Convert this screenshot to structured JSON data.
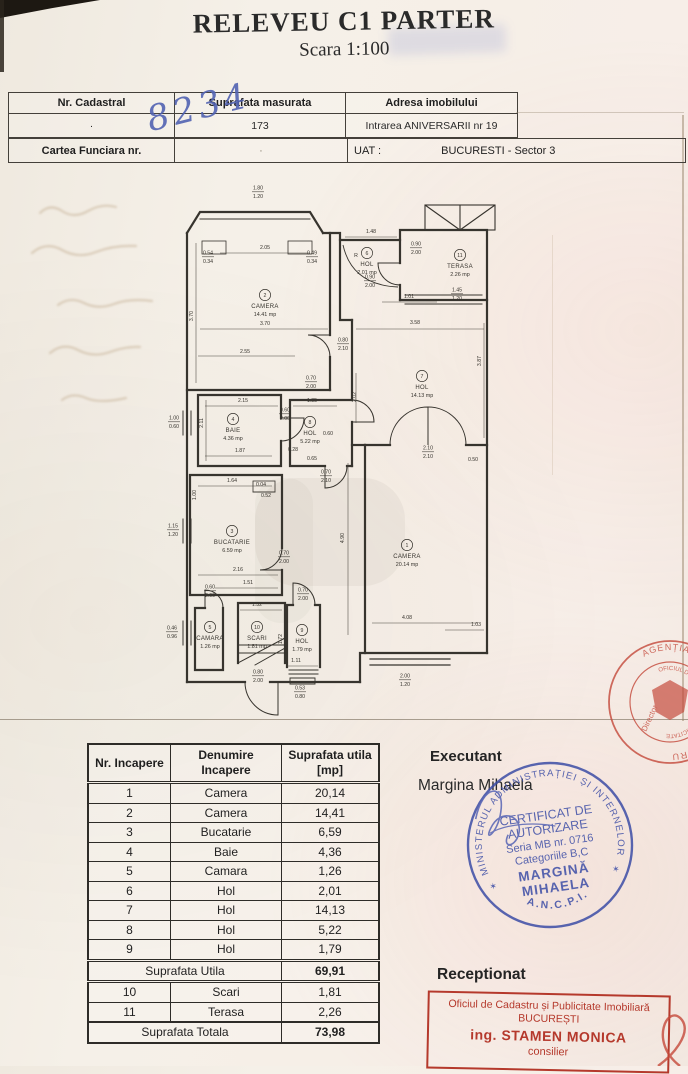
{
  "title": "RELEVEU C1 PARTER",
  "subtitle": "Scara 1:100",
  "header": {
    "nr_cadastral_label": "Nr. Cadastral",
    "nr_cadastral_value": "8234",
    "suprafata_label": "Suprafata masurata",
    "suprafata_value": "173",
    "adresa_label": "Adresa imobilului",
    "adresa_value": "Intrarea ANIVERSARII nr 19",
    "carte_funciara_label": "Cartea Funciara nr.",
    "uat_label": "UAT :",
    "uat_value": "BUCURESTI - Sector 3"
  },
  "plan": {
    "rooms": [
      {
        "num": "1",
        "name": "CAMERA",
        "area": "20.14 mp",
        "x": 247,
        "y": 366
      },
      {
        "num": "2",
        "name": "CAMERA",
        "area": "14.41 mp",
        "x": 105,
        "y": 116
      },
      {
        "num": "3",
        "name": "BUCATARIE",
        "area": "6.59 mp",
        "x": 72,
        "y": 352
      },
      {
        "num": "4",
        "name": "BAIE",
        "area": "4.36 mp",
        "x": 73,
        "y": 240
      },
      {
        "num": "5",
        "name": "CAMARA",
        "area": "1.26 mp",
        "x": 50,
        "y": 448
      },
      {
        "num": "6",
        "name": "HOL",
        "area": "2.01 mp",
        "x": 207,
        "y": 74
      },
      {
        "num": "7",
        "name": "HOL",
        "area": "14.13 mp",
        "x": 262,
        "y": 197
      },
      {
        "num": "8",
        "name": "HOL",
        "area": "5.22 mp",
        "x": 150,
        "y": 243
      },
      {
        "num": "9",
        "name": "HOL",
        "area": "1.79 mp",
        "x": 142,
        "y": 451
      },
      {
        "num": "10",
        "name": "SCARI",
        "area": "1.81 mp",
        "x": 97,
        "y": 448
      },
      {
        "num": "11",
        "name": "TERASA",
        "area": "2.26 mp",
        "x": 300,
        "y": 76
      }
    ],
    "dims": [
      {
        "a": "1.80",
        "b": "1.20",
        "x": 98,
        "y": 8
      },
      {
        "t": "2.05",
        "x": 105,
        "y": 66
      },
      {
        "a": "0.54",
        "b": "0.34",
        "x": 48,
        "y": 73
      },
      {
        "a": "0.49",
        "b": "0.34",
        "x": 152,
        "y": 73
      },
      {
        "t": "3.70",
        "x": 33,
        "y": 133,
        "rot": true
      },
      {
        "t": "3.70",
        "x": 105,
        "y": 142
      },
      {
        "t": "2.55",
        "x": 85,
        "y": 170
      },
      {
        "a": "0.80",
        "b": "2.10",
        "x": 183,
        "y": 160
      },
      {
        "a": "0.70",
        "b": "2.00",
        "x": 151,
        "y": 198
      },
      {
        "t": "1.48",
        "x": 211,
        "y": 50
      },
      {
        "t": "R",
        "x": 196,
        "y": 74
      },
      {
        "a": "0.90",
        "b": "2.00",
        "x": 256,
        "y": 64
      },
      {
        "a": "0.90",
        "b": "2.00",
        "x": 210,
        "y": 97
      },
      {
        "t": "1.01",
        "x": 249,
        "y": 115
      },
      {
        "a": "1.45",
        "b": "1.20",
        "x": 297,
        "y": 110
      },
      {
        "t": "3.58",
        "x": 255,
        "y": 141
      },
      {
        "t": "2.02",
        "x": 196,
        "y": 214,
        "rot": true
      },
      {
        "t": "3.87",
        "x": 321,
        "y": 178,
        "rot": true
      },
      {
        "a": "2.10",
        "b": "2.10",
        "x": 268,
        "y": 268
      },
      {
        "t": "0.50",
        "x": 313,
        "y": 278
      },
      {
        "t": "4.90",
        "x": 184,
        "y": 355,
        "rot": true
      },
      {
        "t": "4.08",
        "x": 247,
        "y": 436
      },
      {
        "t": "1.03",
        "x": 316,
        "y": 443
      },
      {
        "a": "2.00",
        "b": "1.20",
        "x": 245,
        "y": 496
      },
      {
        "t": "2.15",
        "x": 83,
        "y": 219
      },
      {
        "t": "2.11",
        "x": 43,
        "y": 240,
        "rot": true
      },
      {
        "t": "1.87",
        "x": 80,
        "y": 269
      },
      {
        "a": "0.60",
        "b": "2.00",
        "x": 125,
        "y": 230
      },
      {
        "t": "1.35",
        "x": 152,
        "y": 219
      },
      {
        "t": "0.28",
        "x": 133,
        "y": 268
      },
      {
        "t": "0.65",
        "x": 152,
        "y": 277
      },
      {
        "t": "0.60",
        "x": 168,
        "y": 252
      },
      {
        "a": "0.70",
        "b": "2.10",
        "x": 166,
        "y": 292
      },
      {
        "t": "1.64",
        "x": 72,
        "y": 299
      },
      {
        "t": "1.00",
        "x": 36,
        "y": 312,
        "rot": true
      },
      {
        "t": "0.04",
        "x": 101,
        "y": 303
      },
      {
        "t": "0.52",
        "x": 106,
        "y": 314
      },
      {
        "a": "0.70",
        "b": "2.00",
        "x": 124,
        "y": 373
      },
      {
        "t": "2.16",
        "x": 78,
        "y": 388
      },
      {
        "t": "1.51",
        "x": 88,
        "y": 401
      },
      {
        "a": "0.60",
        "b": "2.00",
        "x": 50,
        "y": 407
      },
      {
        "a": "1.00",
        "b": "0.60",
        "x": 14,
        "y": 238
      },
      {
        "a": "1.15",
        "b": "1.20",
        "x": 13,
        "y": 346
      },
      {
        "a": "0.46",
        "b": "0.96",
        "x": 12,
        "y": 448
      },
      {
        "t": "1.32",
        "x": 97,
        "y": 423
      },
      {
        "t": "1.72",
        "x": 122,
        "y": 456,
        "rot": true
      },
      {
        "a": "0.70",
        "b": "2.00",
        "x": 143,
        "y": 410
      },
      {
        "t": "1.11",
        "x": 136,
        "y": 479
      },
      {
        "a": "0.80",
        "b": "2.00",
        "x": 98,
        "y": 492
      },
      {
        "a": "0.53",
        "b": "0.80",
        "x": 140,
        "y": 508
      }
    ]
  },
  "area_table": {
    "headers": [
      "Nr. Incapere",
      "Denumire\nIncapere",
      "Suprafata utila\n[mp]"
    ],
    "rows": [
      [
        "1",
        "Camera",
        "20,14"
      ],
      [
        "2",
        "Camera",
        "14,41"
      ],
      [
        "3",
        "Bucatarie",
        "6,59"
      ],
      [
        "4",
        "Baie",
        "4,36"
      ],
      [
        "5",
        "Camara",
        "1,26"
      ],
      [
        "6",
        "Hol",
        "2,01"
      ],
      [
        "7",
        "Hol",
        "14,13"
      ],
      [
        "8",
        "Hol",
        "5,22"
      ],
      [
        "9",
        "Hol",
        "1,79"
      ]
    ],
    "subtotal_label": "Suprafata Utila",
    "subtotal_value": "69,91",
    "rows2": [
      [
        "10",
        "Scari",
        "1,81"
      ],
      [
        "11",
        "Terasa",
        "2,26"
      ]
    ],
    "total_label": "Suprafata Totala",
    "total_value": "73,98"
  },
  "executant_label": "Executant",
  "executant_name": "Margina Mihaela",
  "receptionat_label": "Receptionat",
  "stamps": {
    "blue": {
      "ring": "MINISTERUL ADMINISTRAȚIEI ȘI INTERNELOR",
      "bottom": "A.N.C.P.I.",
      "lines": [
        "CERTIFICAT DE",
        "AUTORIZARE",
        "Seria MB nr. 0716",
        "Categoriile B,C",
        "MARGINĂ",
        "MIHAELA"
      ],
      "color": "#3c4da6"
    },
    "red_round": {
      "ring_outer": "AGENȚIA NAȚIONALĂ DE CADASTRU",
      "ring_inner": "OFICIUL DE CADASTRU ȘI PUBLICITATE",
      "center": "Director",
      "color": "#c4483a"
    },
    "red_rect": {
      "line1": "Oficiul de Cadastru și Publicitate Imobiliară",
      "line2": "BUCUREȘTI",
      "line3": "ing. STAMEN MONICA",
      "line4": "consilier",
      "color": "#b5392c"
    }
  }
}
